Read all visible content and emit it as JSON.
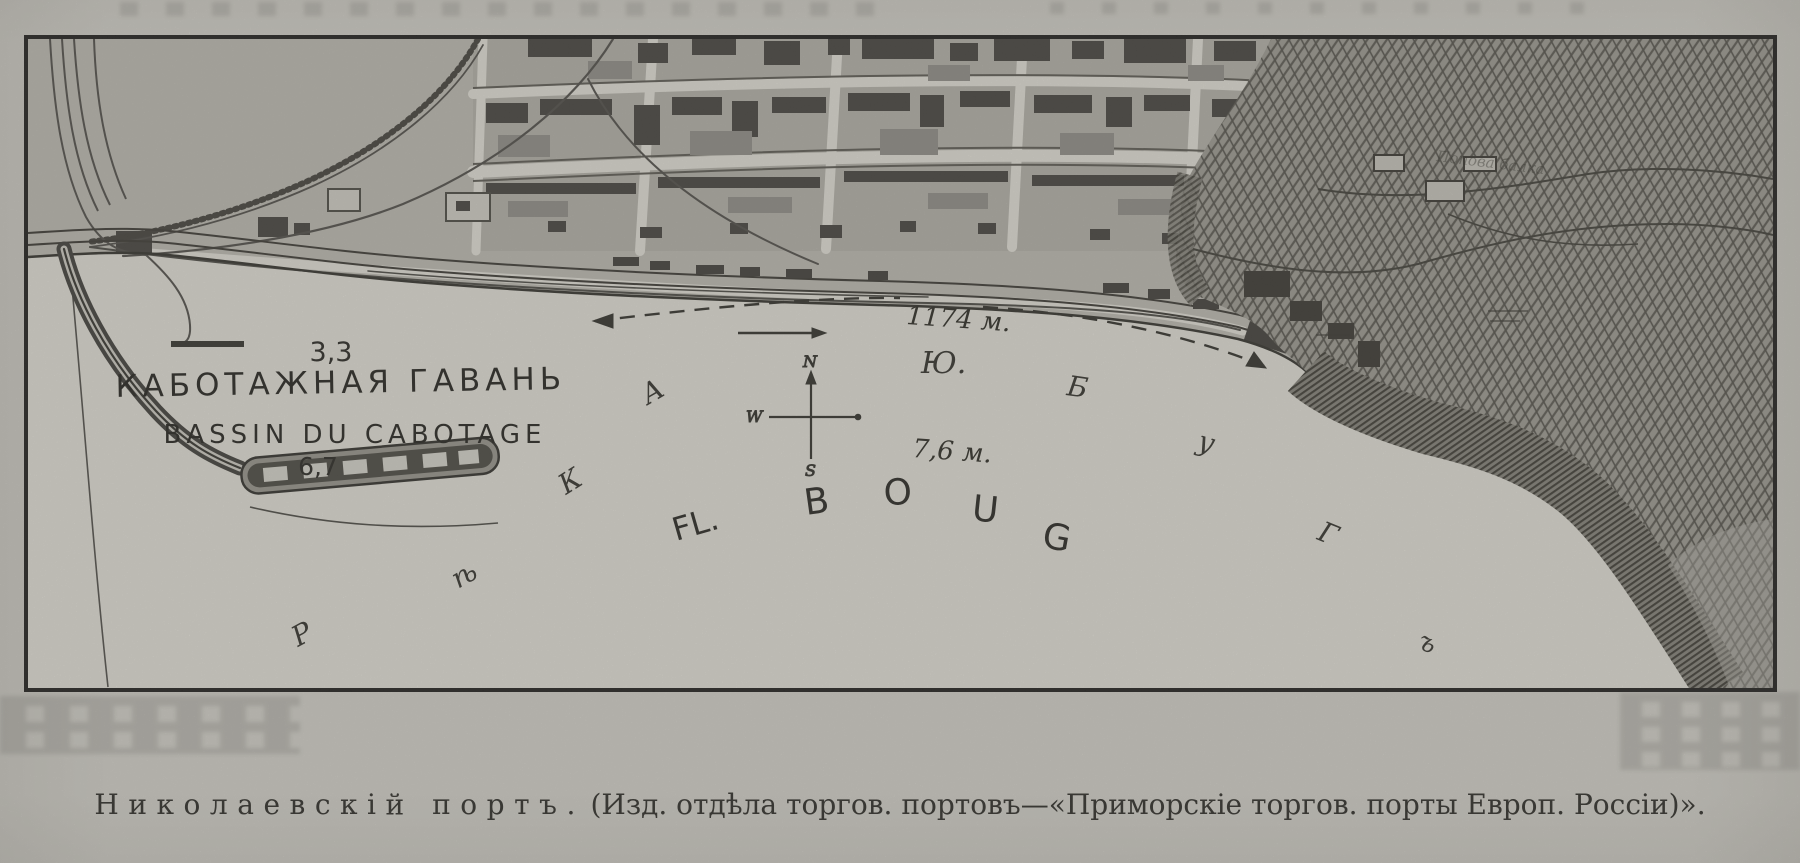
{
  "figure": {
    "caption_title": "Николаевскій портъ.",
    "caption_rest": "(Изд. отдѣла торгов. портовъ—«Приморскіе торгов. порты Европ. Россіи)»."
  },
  "map": {
    "harbor": {
      "name_ru": "КАБОТАЖНАЯ ГАВАНЬ",
      "name_fr": "BASSIN DU CABOTAGE",
      "depth_north": "3,3",
      "depth_south": "6,7"
    },
    "river": {
      "depth_label": "7,6 м.",
      "latin_name_prefix": "FL.",
      "latin_letters": [
        "B",
        "O",
        "U",
        "G"
      ],
      "cyrillic_reka": [
        "Р",
        "ѣ",
        "К",
        "А"
      ],
      "cyrillic_bug": [
        "Ю.",
        "Б",
        "у",
        "Г",
        "ъ"
      ]
    },
    "quay": {
      "length_label": "1174 м."
    },
    "compass": {
      "north": "N",
      "west": "W",
      "south": "S"
    },
    "terrain": {
      "ravine_label": "Попова балка"
    }
  }
}
